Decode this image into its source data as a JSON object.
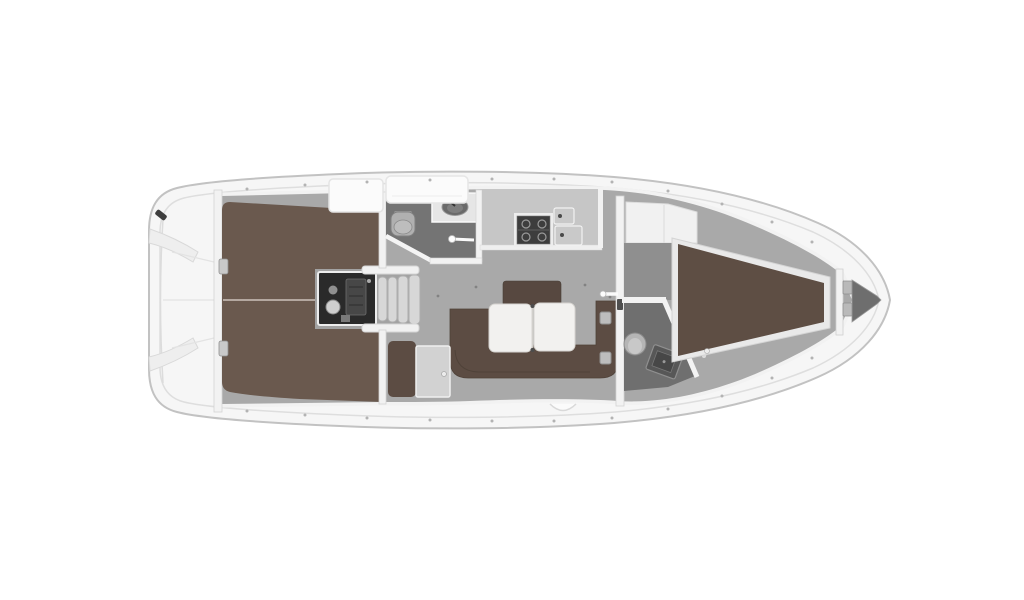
{
  "canvas": {
    "background": "#ffffff"
  },
  "diagram": {
    "kind": "yacht-interior-layout-plan",
    "orientation": "bow-right",
    "areas": [
      {
        "id": "stern-deck",
        "desc": "transom with two curved lazarette benches"
      },
      {
        "id": "aft-double-berth",
        "desc": "large brown double berth with center seam"
      },
      {
        "id": "engine-compartment",
        "desc": "dark engine box under companionway"
      },
      {
        "id": "companionway-steps",
        "desc": "four ribbed steps down to saloon"
      },
      {
        "id": "aft-head",
        "desc": "bathroom with toilet, vanity sink, angled door"
      },
      {
        "id": "galley",
        "desc": "counter with stove and double sink"
      },
      {
        "id": "saloon-settee",
        "desc": "U-shaped brown settee"
      },
      {
        "id": "saloon-table",
        "desc": "white two-leaf folding table"
      },
      {
        "id": "nav-station",
        "desc": "chart table with brown seat"
      },
      {
        "id": "forward-head",
        "desc": "bathroom with toilet and angled sink"
      },
      {
        "id": "forward-wardrobe",
        "desc": "white cabinet at cabin entrance"
      },
      {
        "id": "forward-v-berth",
        "desc": "tapering brown V-berth"
      },
      {
        "id": "anchor-locker",
        "desc": "dark chain locker in bow tip"
      }
    ]
  },
  "colors": {
    "background": "#ffffff",
    "hull_fill": "#f6f6f6",
    "hull_outline": "#c2c2c2",
    "deck_line": "#dedede",
    "wall": "#f2f2f2",
    "floor": "#a9a9a9",
    "engine_floor": "#a2a2a2",
    "entry_floor": "#8f8f8f",
    "aft_berth": "#6a594e",
    "berth_seam": "#cdc3bb",
    "settee": "#5c4c43",
    "settee_back": "#574840",
    "settee_seam": "#4a3e35",
    "v_berth": "#5e4e44",
    "berth_frame": "#e9e9e9",
    "table": "#f2f1ef",
    "table_edge": "#d6d4d0",
    "head_floor": "#747474",
    "fwd_head_floor": "#6f6f6f",
    "counter": "#c6c6c6",
    "counter_lip": "#efefef",
    "stove": "#3d3d3d",
    "sink": "#c9c9c9",
    "sink_drain": "#4a4a4a",
    "engine": "#2a2a2a",
    "steps": "#d7d7d7",
    "chart_table": "#d2d2d2",
    "nav_seat": "#5c4c43",
    "wardrobe": "#f1f1f1",
    "toilet": "#b0b0b0",
    "toilet_fwd": "#b5b5b5",
    "basin_dark": "#575757",
    "anchor_dark": "#6e6e6e",
    "hatch": "#fbfbfb",
    "fitting": "#bdbdbd",
    "cleat": "#3e3e3e",
    "stanchion": "#b3b3b3"
  }
}
